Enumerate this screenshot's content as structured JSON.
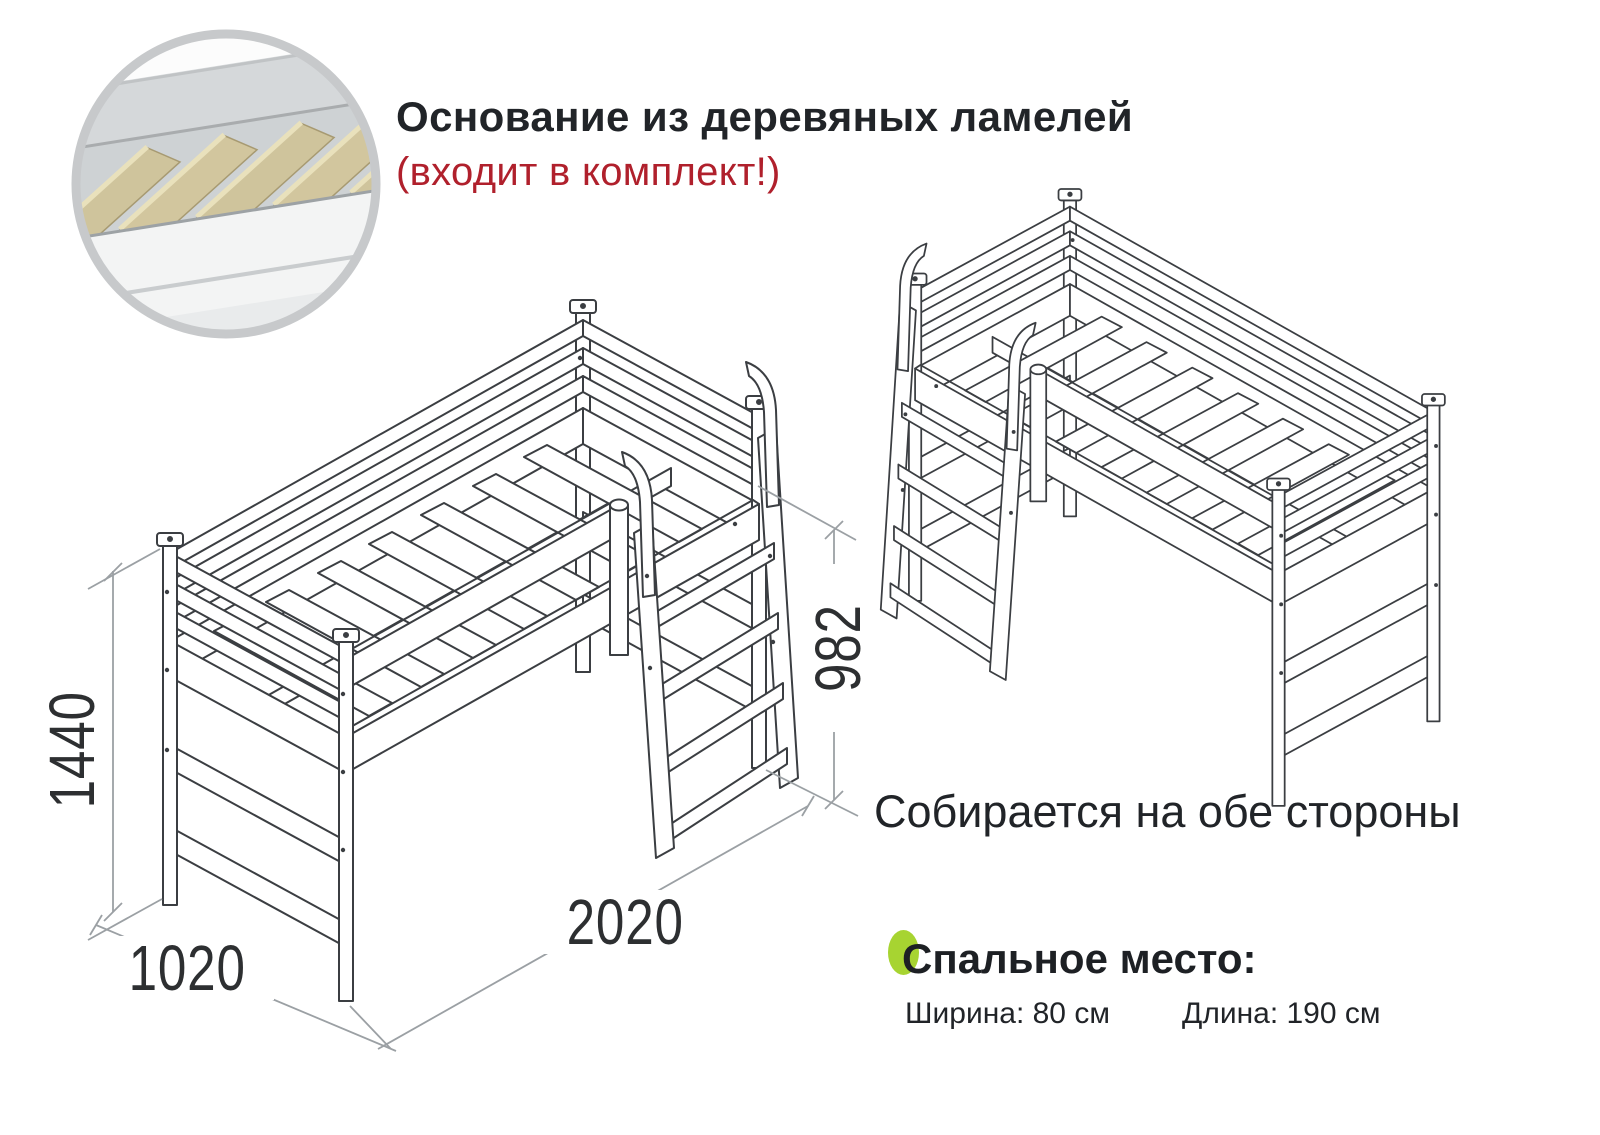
{
  "header": {
    "title": "Основание из деревяных ламелей",
    "subtitle": "(входит в комплект!)"
  },
  "notes": {
    "both_sides": "Собирается на обе стороны"
  },
  "sleeping_area": {
    "title": "Спальное место:",
    "width_spec": "Ширина: 80 см",
    "length_spec": "Длина: 190 см"
  },
  "dimensions_mm": {
    "total_height": "1440",
    "width": "1020",
    "length": "2020",
    "under_bed_clearance": "982"
  },
  "colors": {
    "accent_green": "#a7d431",
    "note_red": "#b0202c",
    "drawing_stroke": "#3b3e42",
    "dimension_gray": "#9ba0a4",
    "slat_wood": "#cfc49c"
  }
}
